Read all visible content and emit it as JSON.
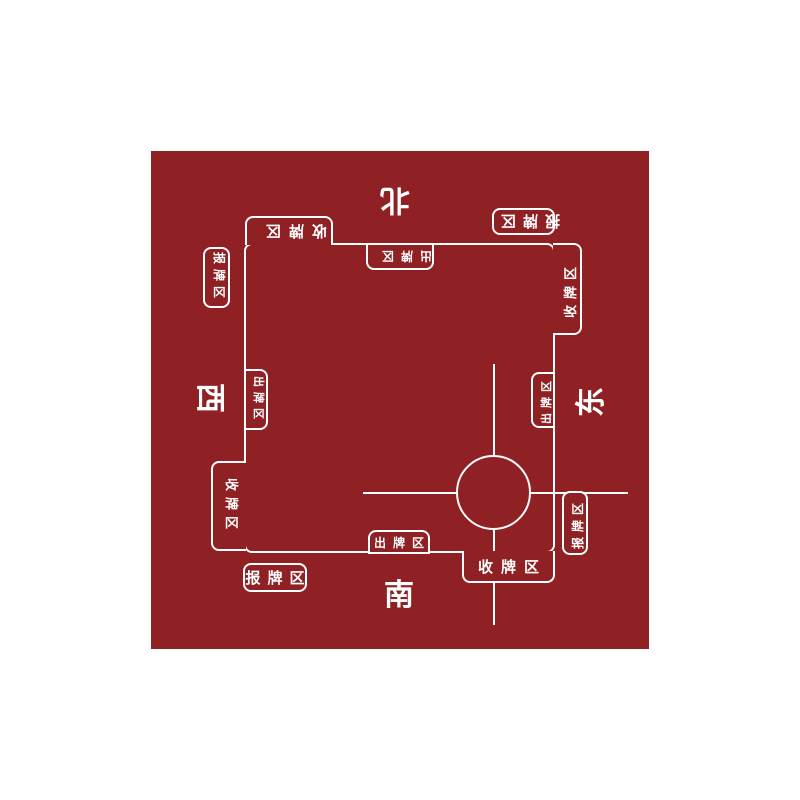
{
  "mat": {
    "background_color": "#8f2125",
    "line_color": "#ffffff",
    "description": "mahjong table mat with four player sides"
  },
  "sides": {
    "north": {
      "direction_label": "北",
      "play_zone_label": "出牌区",
      "collect_zone_label": "收牌区",
      "report_zone_label": "报牌区",
      "orientation": "rotated-180"
    },
    "south": {
      "direction_label": "南",
      "play_zone_label": "出牌区",
      "collect_zone_label": "收牌区",
      "report_zone_label": "报牌区",
      "orientation": "upright"
    },
    "west": {
      "direction_label": "西",
      "play_zone_label": "出牌区",
      "collect_zone_label": "收牌区",
      "report_zone_label": "报牌区",
      "orientation": "rotated-90-cw"
    },
    "east": {
      "direction_label": "东",
      "play_zone_label": "出牌区",
      "collect_zone_label": "收牌区",
      "report_zone_label": "报牌区",
      "orientation": "rotated-90-ccw"
    }
  }
}
